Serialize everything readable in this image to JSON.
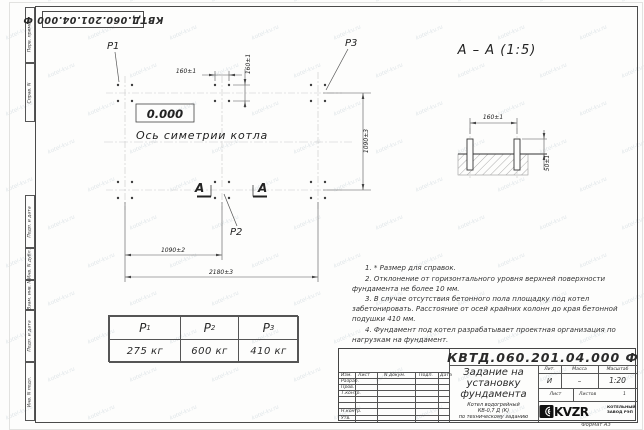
{
  "watermark": {
    "text": "kotel-kv.ru"
  },
  "corner_stamp": {
    "designation": "КВТД.060.201.04.000  Ф"
  },
  "margin_column": {
    "cells": [
      {
        "label": "Перв. примен."
      },
      {
        "label": "Справ. N"
      },
      {
        "label": "Подп. и дата"
      },
      {
        "label": "Инв. N дубл."
      },
      {
        "label": "Взам. инв. N"
      },
      {
        "label": "Подп. и дата"
      },
      {
        "label": "Инв. N подл."
      }
    ]
  },
  "plan": {
    "p1": "P1",
    "p2": "P2",
    "p3": "P3",
    "elevation": "0.000",
    "axis_label": "Ось симетрии котла",
    "dim_bolt_h": "160±1",
    "dim_bolt_v": "160±1",
    "dim_rows": "1090±3",
    "dim_cols": "1090±2",
    "dim_total": "2180±3",
    "section_letter_left": "А",
    "section_letter_right": "А"
  },
  "section": {
    "title": "А – А (1:5)",
    "dim_bolts": "160±1",
    "dim_height": "50±1"
  },
  "notes": {
    "items": [
      "1. * Размер для справок.",
      "2. Отклонение от горизонтального уровня верхней поверхности фундамента не более 10 мм.",
      "3. В случае отсутствия бетонного пола площадку под котел забетонировать. Расстояние от осей крайних колонн до края бетонной подушки 410 мм.",
      "4. Фундамент под котел разрабатывает проектная организация по нагрузкам на фундамент."
    ]
  },
  "loads_table": {
    "columns": [
      {
        "symbol": "P",
        "sub": "1",
        "value": "275  кг"
      },
      {
        "symbol": "P",
        "sub": "2",
        "value": "600  кг"
      },
      {
        "symbol": "P",
        "sub": "3",
        "value": "410  кг"
      }
    ]
  },
  "title_block": {
    "designation": "КВТД.060.201.04.000  Ф",
    "doc_title": "Задание на установку фундамента",
    "product_lines": [
      "Котел водогрейный",
      "КВ-0,7 Д (К)",
      "по техническому заданию"
    ],
    "header_cells": [
      "Изм.",
      "Лист",
      "N докум.",
      "Подп.",
      "Дата"
    ],
    "signature_rows": [
      "Разраб.",
      "Пров.",
      "Т.контр.",
      "Н.контр.",
      "Утв."
    ],
    "lit_label": "Лит.",
    "lit_value": "И",
    "mass_label": "Масса",
    "mass_value": "–",
    "scale_label": "Масштаб",
    "scale_value": "1:20",
    "sheet_label": "Лист",
    "sheets_label": "Листов",
    "sheets_value": "1",
    "logo_text": "KVZR",
    "company_lines": [
      "КОТЕЛЬНЫЙ",
      "ЗАВОД РЭП"
    ],
    "format_note": "Формат А3"
  }
}
